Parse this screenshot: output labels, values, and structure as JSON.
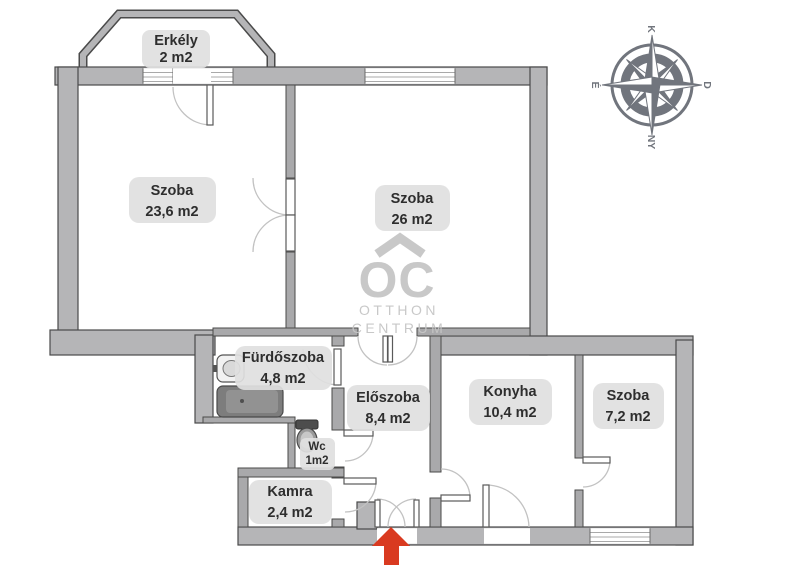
{
  "colors": {
    "wall_fill": "#b5b5b7",
    "iwall_fill": "#a9a9ab",
    "wall_stroke": "#4a4a4a",
    "label_bg": "#e0e0e0",
    "label_text": "#2e2e2e",
    "compass": "#71757d",
    "watermark": "#c6c6c6",
    "arrow_red": "#d93a20"
  },
  "rooms": [
    {
      "id": "erkely",
      "name": "Erkély",
      "area": "2 m2"
    },
    {
      "id": "szoba-nagy",
      "name": "Szoba",
      "area": "23,6 m2"
    },
    {
      "id": "szoba-kozepso",
      "name": "Szoba",
      "area": "26 m2"
    },
    {
      "id": "furdoszoba",
      "name": "Fürdőszoba",
      "area": "4,8 m2"
    },
    {
      "id": "eloszoba",
      "name": "Előszoba",
      "area": "8,4 m2"
    },
    {
      "id": "konyha",
      "name": "Konyha",
      "area": "10,4 m2"
    },
    {
      "id": "szoba-kis",
      "name": "Szoba",
      "area": "7,2 m2"
    },
    {
      "id": "wc",
      "name": "Wc",
      "area": "1m2"
    },
    {
      "id": "kamra",
      "name": "Kamra",
      "area": "2,4 m2"
    }
  ],
  "compass": {
    "top": "K",
    "right": "D",
    "bottom": "NY",
    "left": "É"
  },
  "watermark": {
    "monogram": "OC",
    "line1": "OTTHON",
    "line2": "CENTRUM"
  }
}
